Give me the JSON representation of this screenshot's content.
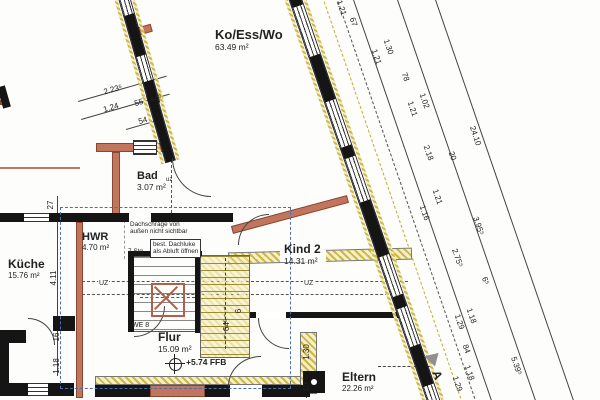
{
  "rooms": [
    {
      "name": "Ko/Ess/Wo",
      "area": "63.49 m²"
    },
    {
      "name": "Bad",
      "area": "3.07 m²"
    },
    {
      "name": "HWR",
      "area": "4.70 m²"
    },
    {
      "name": "Küche",
      "area": "15.76 m²"
    },
    {
      "name": "Kind 2",
      "area": "14.31 m²"
    },
    {
      "name": "Flur",
      "area": "15.09 m²"
    },
    {
      "name": "Eltern",
      "area": "22.26 m²"
    }
  ],
  "notes": {
    "roof_line1": "Dachschräge von",
    "roof_line2": "außen nicht sichtbar",
    "hatch_line1": "best. Dachluke",
    "hatch_line2": "als Abluft öffnen",
    "stairs": "7 Stg",
    "unit": "WE 8",
    "beam": "UZ",
    "beam_small": "uz",
    "level": "+5.74 FFB",
    "section": "A"
  },
  "dimensions": {
    "diagonal_angle_deg": 71,
    "diagonal": [
      {
        "t": "1.21",
        "x": 341,
        "y": 8
      },
      {
        "t": "67",
        "x": 353,
        "y": 22
      },
      {
        "t": "1.30",
        "x": 388,
        "y": 47
      },
      {
        "t": "1.21",
        "x": 376,
        "y": 57
      },
      {
        "t": "78",
        "x": 405,
        "y": 77
      },
      {
        "t": "1.02",
        "x": 424,
        "y": 101
      },
      {
        "t": "1.21",
        "x": 412,
        "y": 109
      },
      {
        "t": "24.10",
        "x": 475,
        "y": 136
      },
      {
        "t": "2.18",
        "x": 428,
        "y": 153
      },
      {
        "t": "20",
        "x": 452,
        "y": 156
      },
      {
        "t": "1.21",
        "x": 437,
        "y": 197
      },
      {
        "t": "1.16",
        "x": 424,
        "y": 213
      },
      {
        "t": "3.95⁵",
        "x": 478,
        "y": 226
      },
      {
        "t": "2.75⁵",
        "x": 457,
        "y": 258
      },
      {
        "t": "6⁵",
        "x": 485,
        "y": 281
      },
      {
        "t": "1.18",
        "x": 471,
        "y": 316
      },
      {
        "t": "1.29",
        "x": 459,
        "y": 322
      },
      {
        "t": "84",
        "x": 466,
        "y": 349
      },
      {
        "t": "5.39⁵",
        "x": 516,
        "y": 366
      },
      {
        "t": "1.18",
        "x": 469,
        "y": 373
      },
      {
        "t": "1.29",
        "x": 457,
        "y": 384
      }
    ],
    "vertical": [
      {
        "t": "27",
        "x": 51,
        "y": 205
      },
      {
        "t": "4.11",
        "x": 54,
        "y": 278
      },
      {
        "t": "16",
        "x": 57,
        "y": 337
      },
      {
        "t": "1.18",
        "x": 57,
        "y": 366
      },
      {
        "t": "6",
        "x": 239,
        "y": 311
      },
      {
        "t": "64⁵",
        "x": 227,
        "y": 325
      },
      {
        "t": "1.30",
        "x": 307,
        "y": 352
      },
      {
        "t": "10",
        "x": 307,
        "y": 387
      }
    ],
    "tilted": [
      {
        "t": "2.23⁵",
        "x": 113,
        "y": 90
      },
      {
        "t": "1.24",
        "x": 111,
        "y": 108
      },
      {
        "t": "55",
        "x": 139,
        "y": 103
      },
      {
        "t": "44⁵",
        "x": 156,
        "y": 99
      },
      {
        "t": "54",
        "x": 143,
        "y": 121
      }
    ]
  },
  "walls": {
    "right-exterior": {
      "x": 288,
      "y": -2,
      "angle": -19,
      "thickness": 13,
      "length": 430,
      "segments": [
        {
          "len": 11,
          "t": "solid"
        },
        {
          "len": 52,
          "t": "win"
        },
        {
          "len": 48,
          "t": "solid"
        },
        {
          "len": 48,
          "t": "win"
        },
        {
          "len": 12,
          "t": "solid"
        },
        {
          "len": 46,
          "t": "win"
        },
        {
          "len": 58,
          "t": "solid"
        },
        {
          "len": 42,
          "t": "win"
        },
        {
          "len": 13,
          "t": "solid"
        },
        {
          "len": 40,
          "t": "win"
        },
        {
          "len": 42,
          "t": "solid"
        },
        {
          "len": 18,
          "t": "win"
        }
      ]
    },
    "left-upper": {
      "x": 118,
      "y": -2,
      "angle": -16,
      "thickness": 12,
      "length": 112,
      "segments": [
        {
          "len": 19,
          "t": "win"
        },
        {
          "len": 43,
          "t": "solid"
        },
        {
          "len": 26,
          "t": "win"
        },
        {
          "len": 24,
          "t": "solid"
        }
      ]
    },
    "bad-left": {
      "x": 146,
      "y": 96,
      "angle": -16,
      "thickness": 11,
      "length": 70,
      "segments": [
        {
          "len": 70,
          "t": "solid"
        }
      ]
    }
  },
  "colors": {
    "new_wall_red": "#c0755c",
    "existing_hatch_yellow": "#cdb93a",
    "wall_black": "#151515",
    "selection_blue": "#4e6fae"
  }
}
